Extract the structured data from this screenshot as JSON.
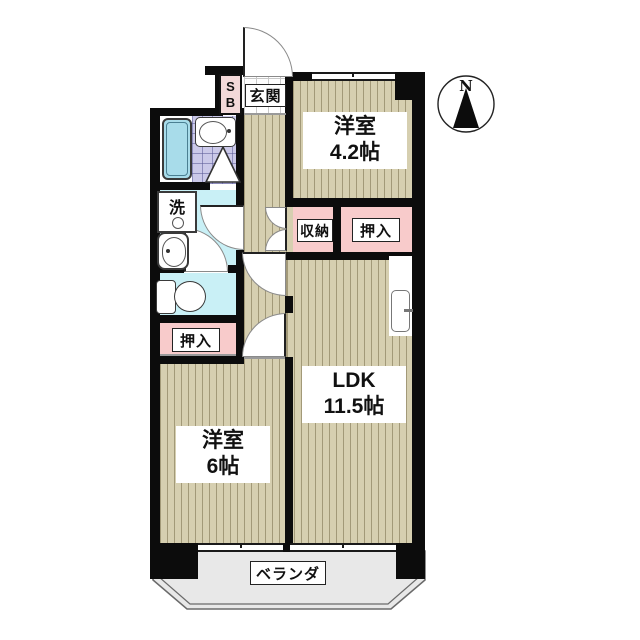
{
  "compass": {
    "label": "N"
  },
  "entrance": {
    "label": "玄関",
    "shoebox_line1": "S",
    "shoebox_line2": "B"
  },
  "rooms": {
    "western42": {
      "name": "洋室",
      "size": "4.2帖"
    },
    "ldk": {
      "name": "LDK",
      "size": "11.5帖"
    },
    "western6": {
      "name": "洋室",
      "size": "6帖"
    }
  },
  "storage": {
    "shuno": "収納",
    "oshiire_right": "押入",
    "oshiire_left": "押入"
  },
  "sanitary": {
    "laundry": "洗"
  },
  "balcony": {
    "label": "ベランダ"
  },
  "colors": {
    "wall": "#0c0c0c",
    "room_floor": "#d6cfb0",
    "closet": "#f8cbcb",
    "bath_tile": "#cbc9e9",
    "bathtub": "#a8dcea",
    "wet_area_floor": "#c9f0f6",
    "entrance_tile": "#ffffff",
    "balcony_floor": "#e8e8e8"
  }
}
